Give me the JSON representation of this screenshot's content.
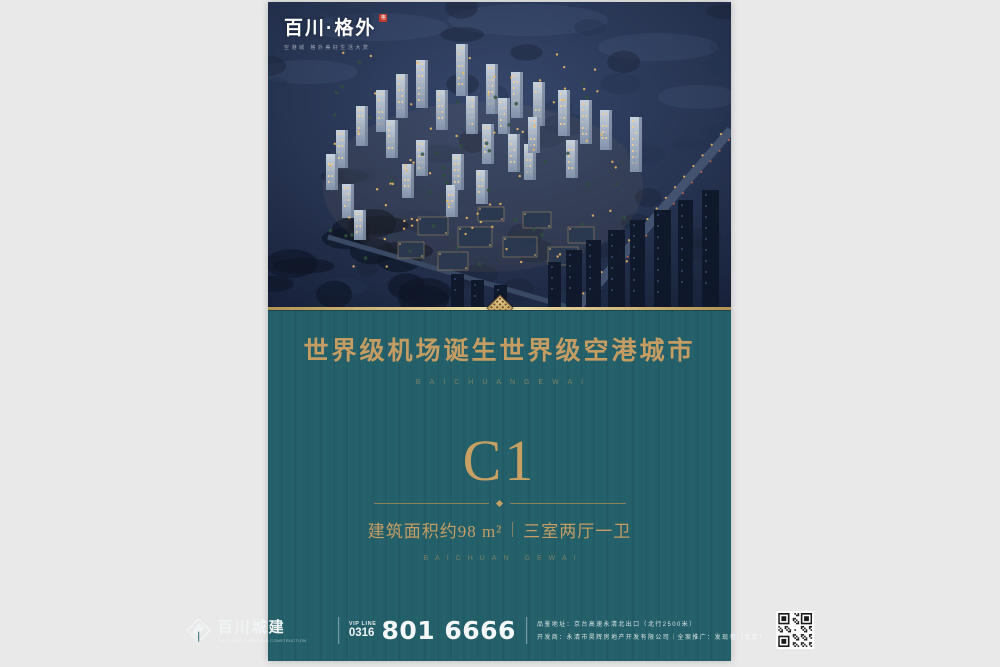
{
  "background_color": "#e9e9e9",
  "poster": {
    "colors": {
      "teal": "#24606a",
      "gold_text": "#c59d63",
      "gold_line": "#e8d5a2",
      "night_sky": "#2c3b57",
      "seal_red": "#c23a2c",
      "footer_white": "#f0f4f5"
    },
    "hero": {
      "brand_logo": "百川·格外",
      "brand_seal": "格",
      "brand_tagline": "空港城 格外美好生活大赏"
    },
    "headline": {
      "title": "世界级机场诞生世界级空港城市",
      "subtitle": "BAICHUANGEWAI"
    },
    "unit": {
      "name": "C1",
      "area": "建筑面积约98 m²",
      "layout": "三室两厅一卫",
      "caption": "BAICHUAN GEWAI"
    },
    "footer": {
      "company_name": "百川城建",
      "company_sub": "BAICHUAN CHENGJIAN CONSTRUCTION",
      "vip_label": "VIP LINE",
      "vip_code": "0316",
      "phone": "801 6666",
      "address": "品鉴地址：京台高速永清北出口（北行2500米）",
      "developer": "开发商：永清市昊辉房地产开发有限公司｜全案推广：发现者（北京）"
    }
  }
}
